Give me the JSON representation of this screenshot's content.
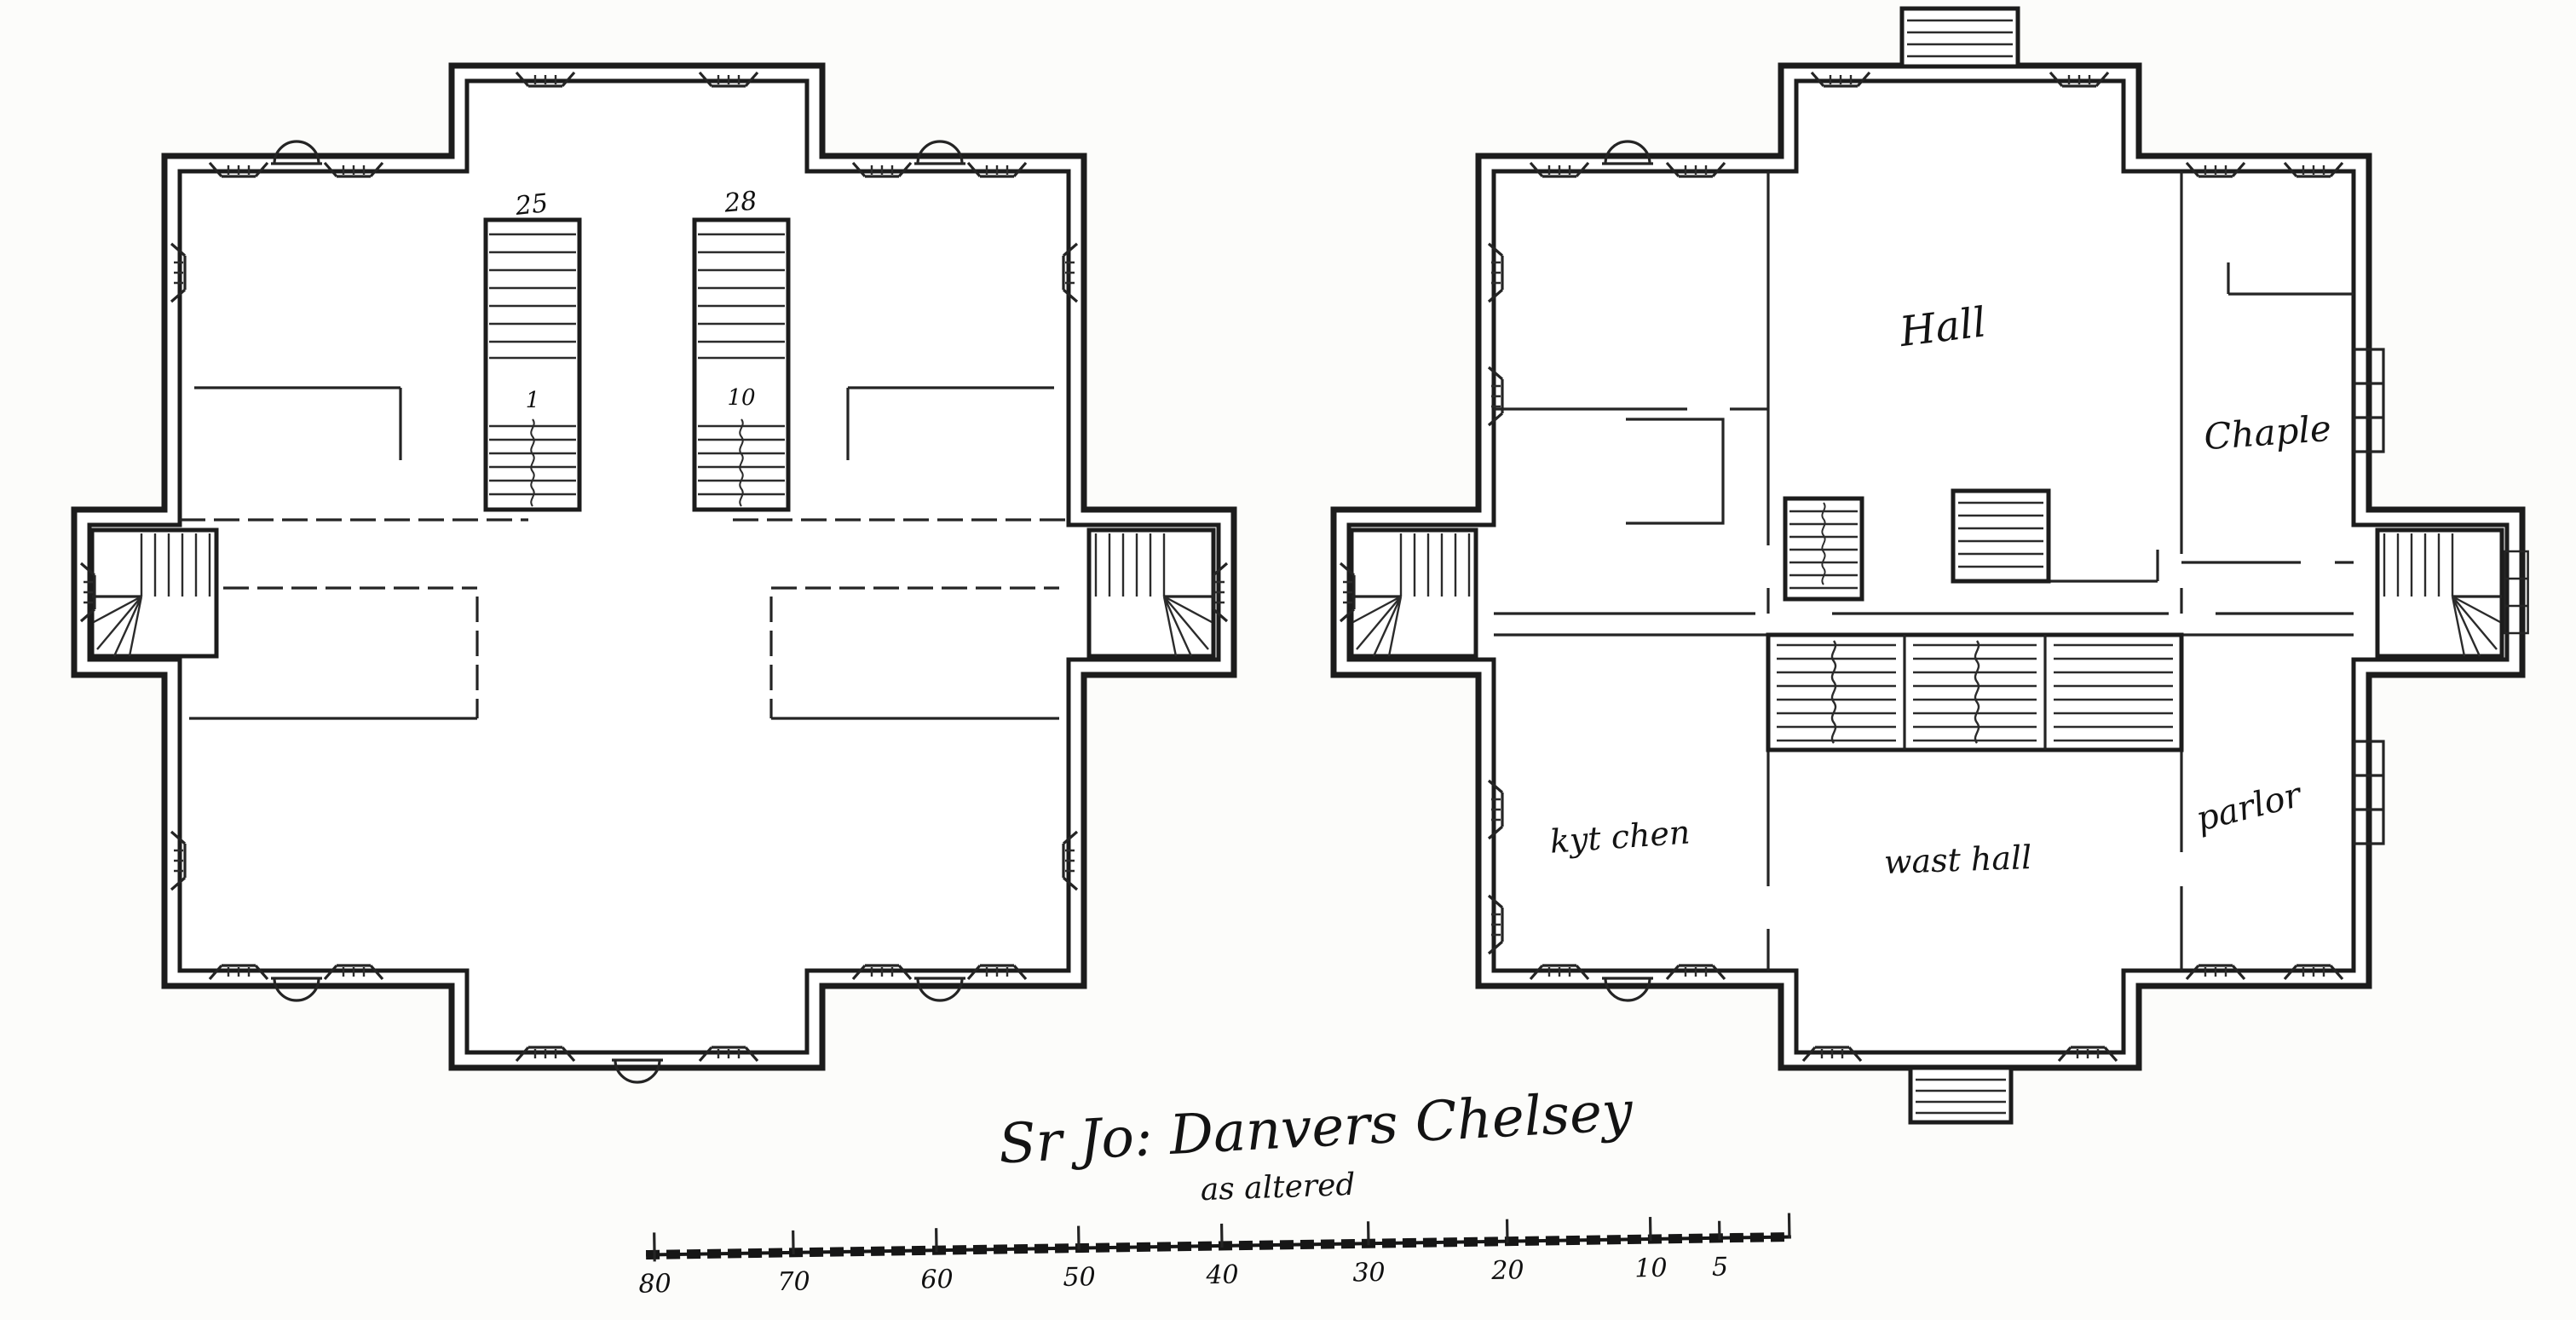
{
  "caption": {
    "main": "Sr Jo: Danvers Chelsey",
    "sub": "as altered"
  },
  "plans": {
    "left": {
      "stair_numbers": {
        "upper_left": "25",
        "upper_right": "28",
        "landing_left": "1",
        "landing_right": "10"
      }
    },
    "right": {
      "rooms": {
        "hall": "Hall",
        "chapel": "Chaple",
        "parlor": "parlor",
        "kitchen": "kyt chen",
        "waste_hall": "wast hall"
      }
    }
  },
  "scale_bar": {
    "labels": [
      "80",
      "70",
      "60",
      "50",
      "40",
      "30",
      "20",
      "10",
      "5"
    ]
  }
}
